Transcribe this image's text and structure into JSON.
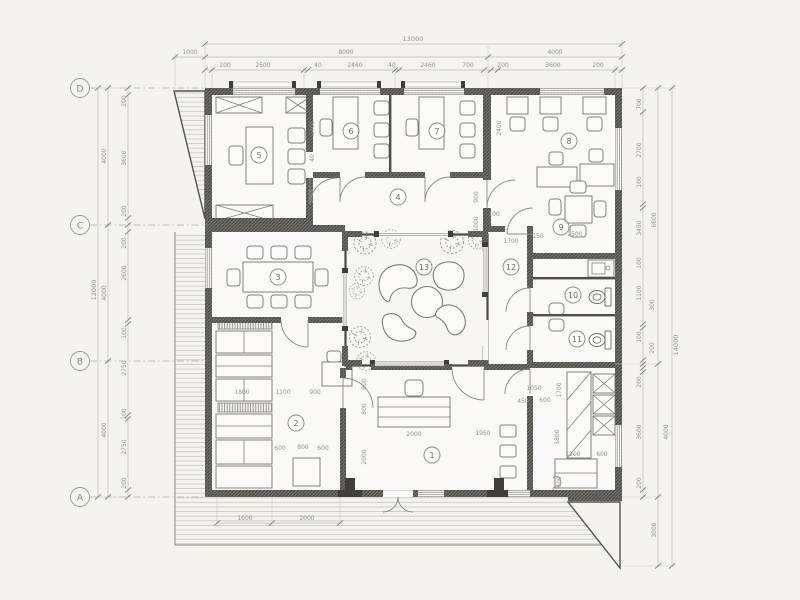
{
  "grid_axes": [
    "D",
    "C",
    "B",
    "A"
  ],
  "room_numbers": [
    "1",
    "2",
    "3",
    "4",
    "5",
    "6",
    "7",
    "8",
    "9",
    "10",
    "11",
    "12",
    "13"
  ],
  "dims": {
    "top1": [
      "13000"
    ],
    "top2": [
      "1000",
      "8000",
      "4000"
    ],
    "top3": [
      "200",
      "2600",
      "40",
      "2460",
      "40",
      "2460",
      "700",
      "200",
      "3600",
      "200"
    ],
    "left1": [
      "12000"
    ],
    "left2": [
      "4000",
      "4000",
      "4000"
    ],
    "left3": [
      "200",
      "3600",
      "200",
      "200",
      "2600",
      "100",
      "2750",
      "100",
      "2750",
      "200"
    ],
    "right1": [
      "14000"
    ],
    "right2": [
      "6600",
      "4000",
      "3000"
    ],
    "right3": [
      "700",
      "2700",
      "100",
      "3450",
      "100",
      "1100",
      "300",
      "100",
      "200",
      "200",
      "3600",
      "200"
    ],
    "bottom": [
      "1600",
      "2000"
    ],
    "inner": [
      "2400",
      "40",
      "1000",
      "2400",
      "900",
      "1000",
      "100",
      "1700",
      "150",
      "2500",
      "800",
      "800",
      "2000",
      "2000",
      "1950",
      "1800",
      "1100",
      "900",
      "600",
      "800",
      "600",
      "1050",
      "450",
      "600",
      "1700",
      "1800",
      "1200",
      "600",
      "600"
    ]
  }
}
